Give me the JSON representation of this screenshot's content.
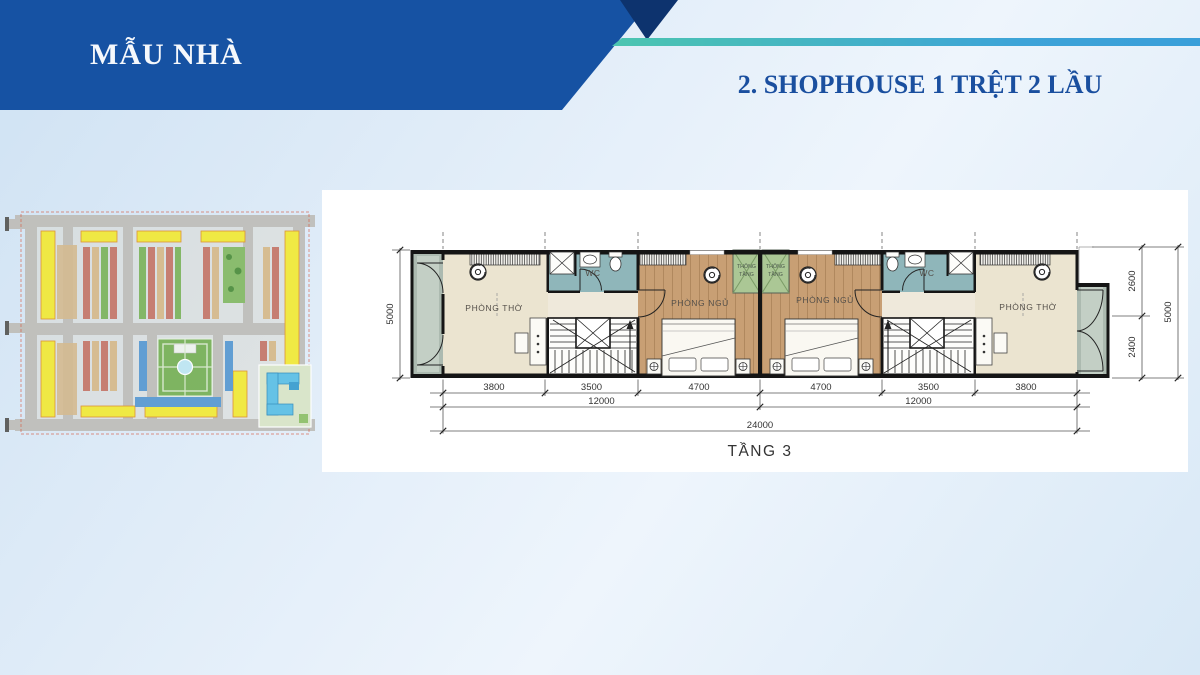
{
  "slide": {
    "header_title": "MẪU NHÀ",
    "section_title": "2. SHOPHOUSE 1 TRỆT 2 LẦU"
  },
  "floor_plan": {
    "caption": "TẦNG 3",
    "rooms": {
      "worship_left": "PHÒNG THỜ",
      "worship_right": "PHÒNG THỜ",
      "bedroom_left": "PHÒNG NGỦ",
      "bedroom_right": "PHÒNG NGỦ",
      "wc_left": "WC",
      "wc_right": "WC",
      "void_line1": "THÔNG",
      "void_line2": "TẦNG"
    },
    "dims": {
      "bottom": [
        "3800",
        "3500",
        "4700",
        "4700",
        "3500",
        "3800"
      ],
      "mid": [
        "12000",
        "12000"
      ],
      "total": "24000",
      "left_total": "5000",
      "right": [
        "2600",
        "2400",
        "5000"
      ]
    }
  },
  "site_map": {
    "description": "master plan thumbnail"
  },
  "colors": {
    "banner": "#1652a3",
    "banner_dark": "#0d336e",
    "accent_teal": "#4cc5b0",
    "accent_blue": "#3da3d8",
    "title_text": "#1a4f9f"
  }
}
